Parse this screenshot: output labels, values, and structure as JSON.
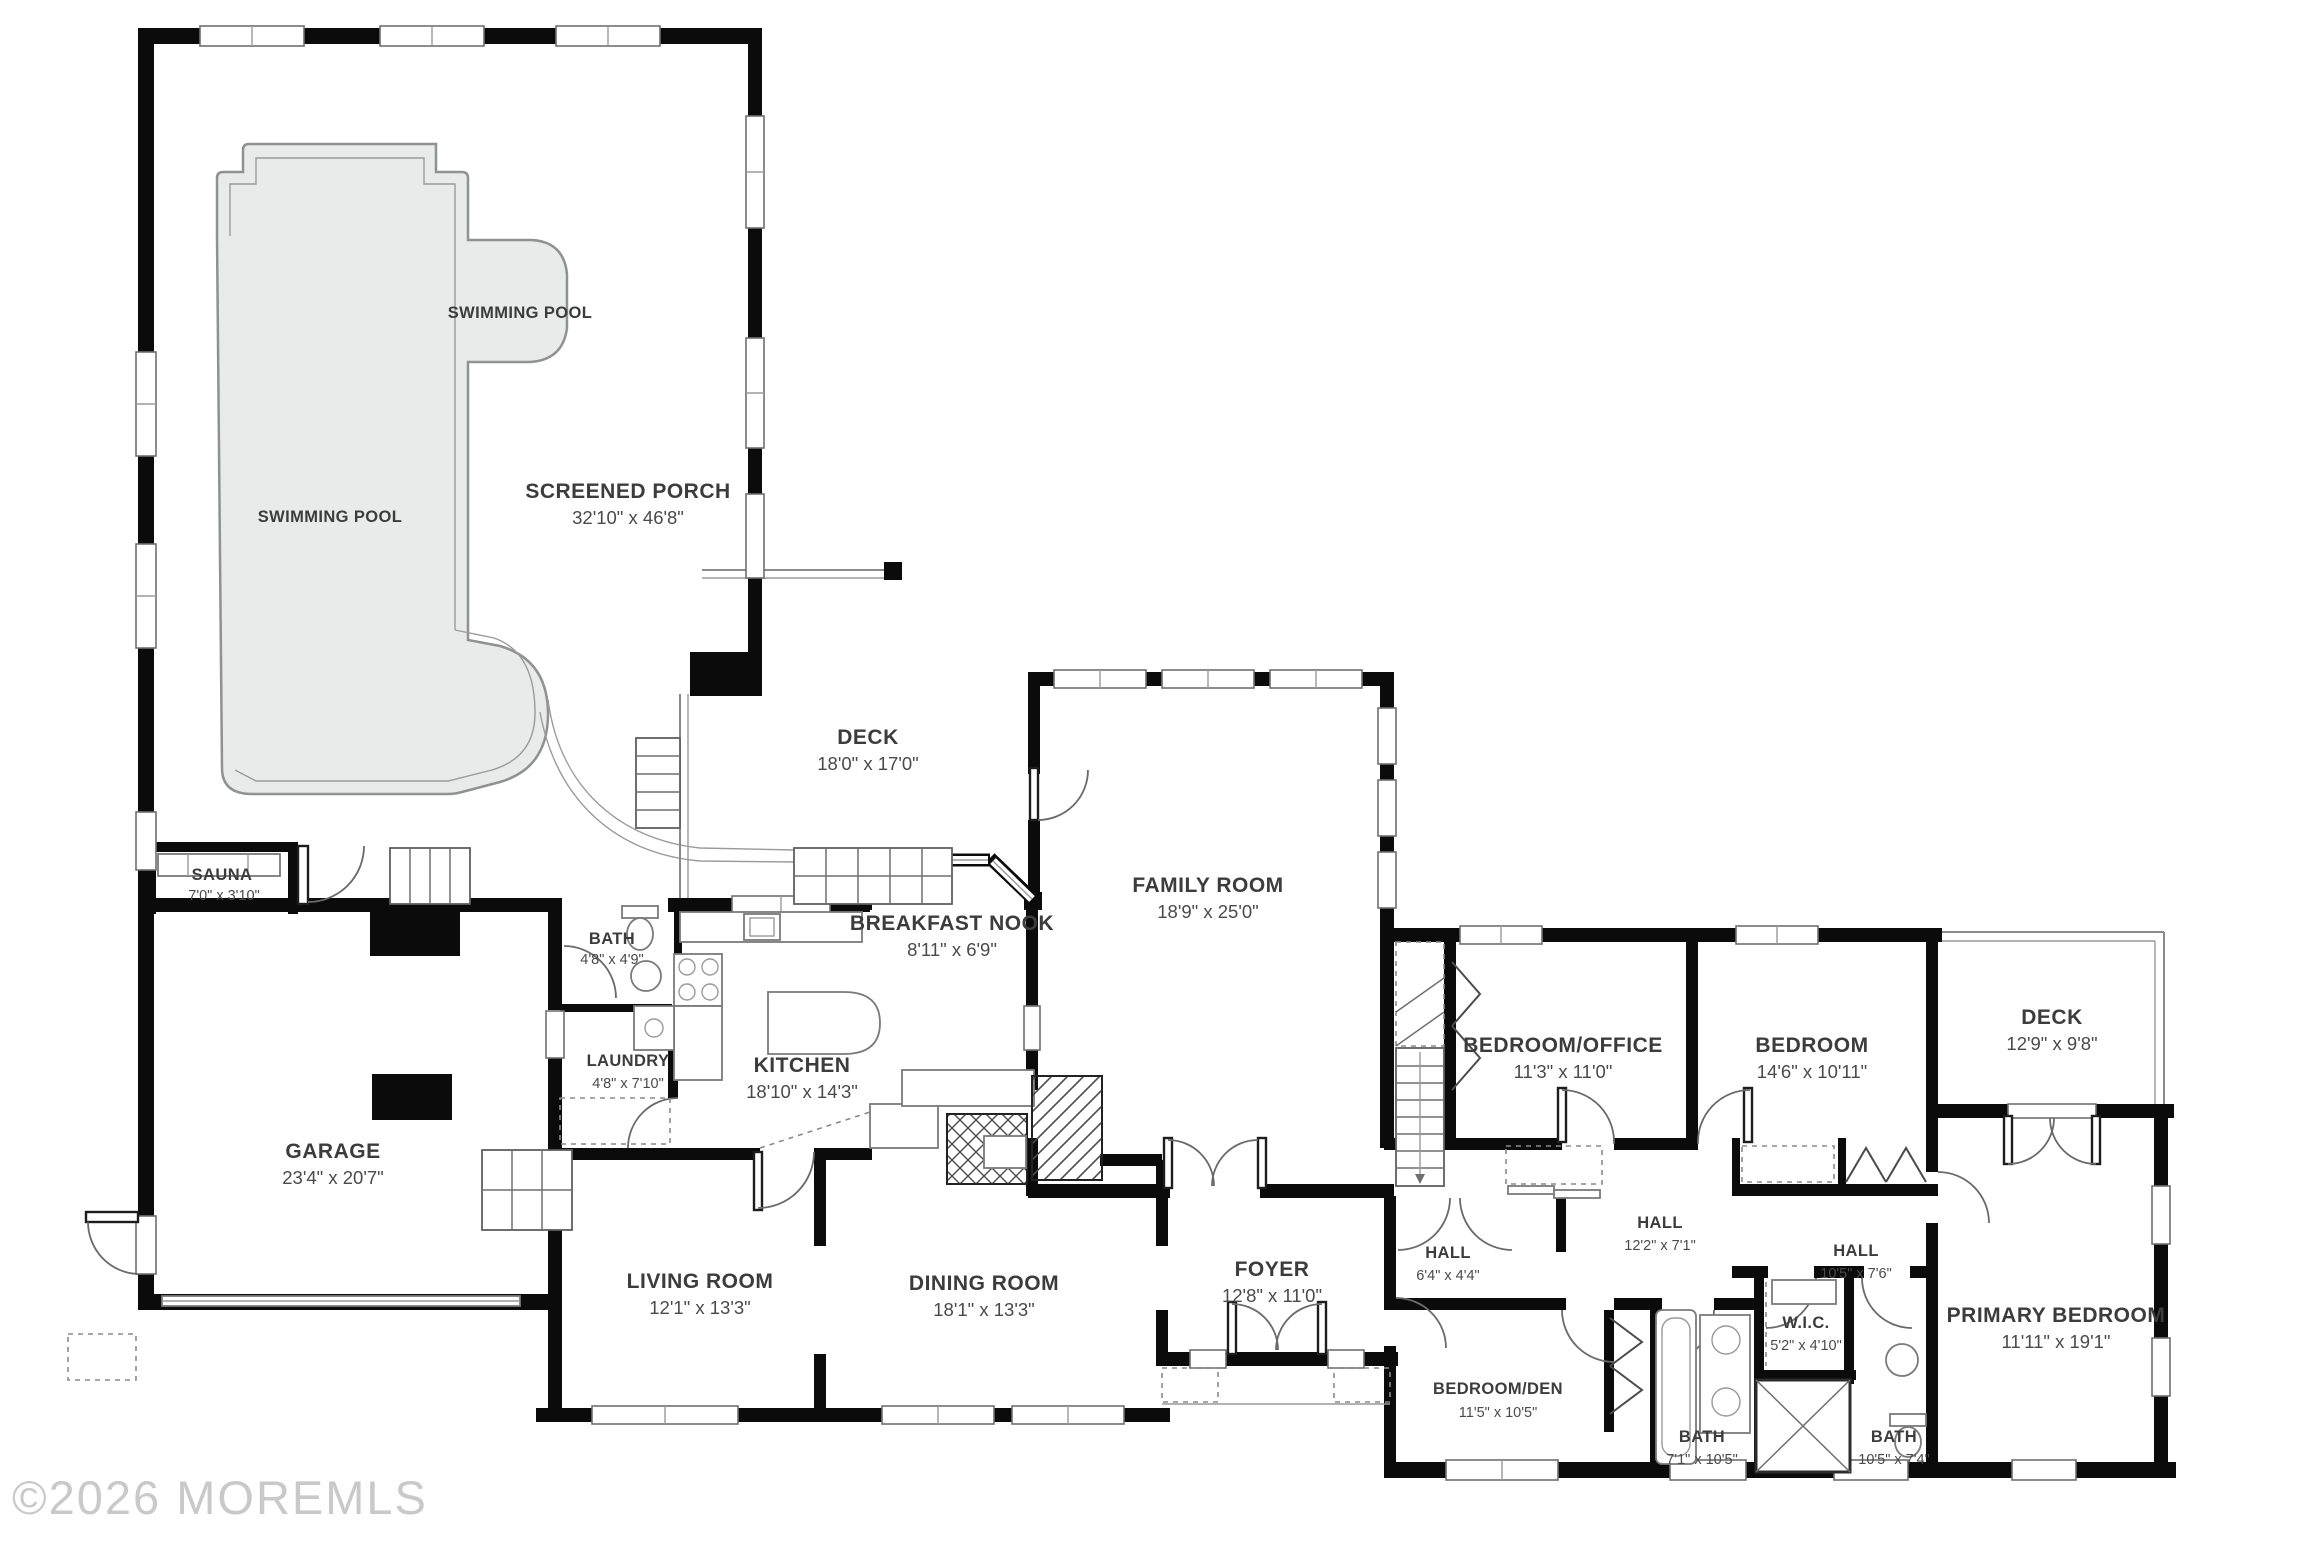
{
  "meta": {
    "watermark": "©2026 MOREMLS"
  },
  "pool": {
    "label": "SWIMMING POOL"
  },
  "rooms": [
    {
      "id": "screened-porch",
      "name": "SCREENED PORCH",
      "dims": "32'10\" x 46'8\""
    },
    {
      "id": "sauna",
      "name": "SAUNA",
      "dims": "7'0\" x 3'10\""
    },
    {
      "id": "garage",
      "name": "GARAGE",
      "dims": "23'4\" x 20'7\""
    },
    {
      "id": "deck-main",
      "name": "DECK",
      "dims": "18'0\" x 17'0\""
    },
    {
      "id": "breakfast-nook",
      "name": "BREAKFAST NOOK",
      "dims": "8'11\" x 6'9\""
    },
    {
      "id": "kitchen",
      "name": "KITCHEN",
      "dims": "18'10\" x 14'3\""
    },
    {
      "id": "bath-main",
      "name": "BATH",
      "dims": "4'8\" x 4'9\""
    },
    {
      "id": "laundry",
      "name": "LAUNDRY",
      "dims": "4'8\" x 7'10\""
    },
    {
      "id": "living-room",
      "name": "LIVING ROOM",
      "dims": "12'1\" x 13'3\""
    },
    {
      "id": "dining-room",
      "name": "DINING ROOM",
      "dims": "18'1\" x 13'3\""
    },
    {
      "id": "family-room",
      "name": "FAMILY ROOM",
      "dims": "18'9\" x 25'0\""
    },
    {
      "id": "foyer",
      "name": "FOYER",
      "dims": "12'8\" x 11'0\""
    },
    {
      "id": "hall-small",
      "name": "HALL",
      "dims": "6'4\" x 4'4\""
    },
    {
      "id": "bedroom-office",
      "name": "BEDROOM/OFFICE",
      "dims": "11'3\" x 11'0\""
    },
    {
      "id": "bedroom",
      "name": "BEDROOM",
      "dims": "14'6\" x 10'11\""
    },
    {
      "id": "deck-right",
      "name": "DECK",
      "dims": "12'9\" x 9'8\""
    },
    {
      "id": "hall-center",
      "name": "HALL",
      "dims": "12'2\" x 7'1\""
    },
    {
      "id": "hall-right",
      "name": "HALL",
      "dims": "10'5\" x 7'6\""
    },
    {
      "id": "primary-bedroom",
      "name": "PRIMARY BEDROOM",
      "dims": "11'11\" x 19'1\""
    },
    {
      "id": "bedroom-den",
      "name": "BEDROOM/DEN",
      "dims": "11'5\" x 10'5\""
    },
    {
      "id": "bath-hall",
      "name": "BATH",
      "dims": "7'1\" x 10'5\""
    },
    {
      "id": "wic",
      "name": "W.I.C.",
      "dims": "5'2\" x 4'10\""
    },
    {
      "id": "bath-primary",
      "name": "BATH",
      "dims": "10'5\" x 7'4\""
    }
  ]
}
